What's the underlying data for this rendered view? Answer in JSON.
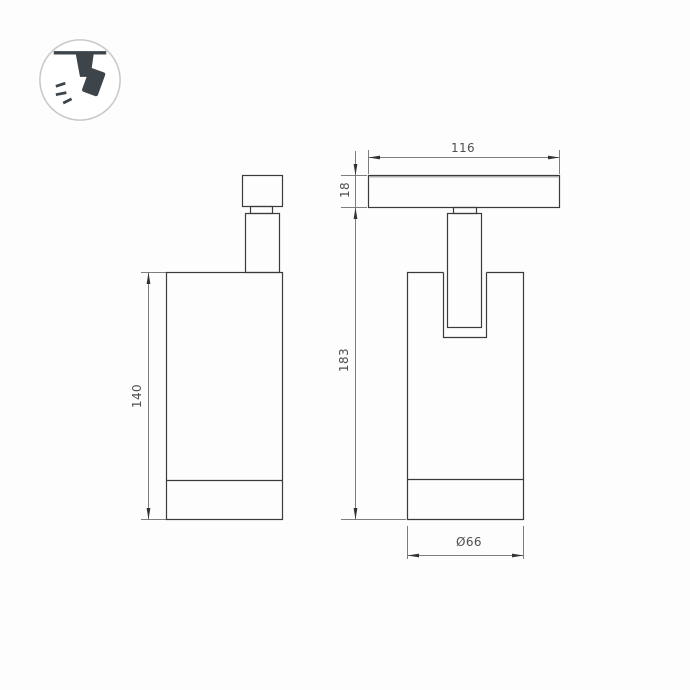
{
  "page": {
    "background": "#fdfdfd"
  },
  "icon": {
    "name": "track-mounted-spotlight",
    "border_color": "#c9c9c9",
    "glyph_color": "#3d444a"
  },
  "drawing": {
    "line_color": "#3b3b3b",
    "dim_line_color": "#7d7d7d",
    "arrow_color": "#333333",
    "text_color": "#4f4f4f",
    "side_view": {
      "height_label": "140"
    },
    "front_view": {
      "track_width_label": "116",
      "track_height_label": "18",
      "total_height_label": "183",
      "diameter_label": "Ø66"
    }
  }
}
